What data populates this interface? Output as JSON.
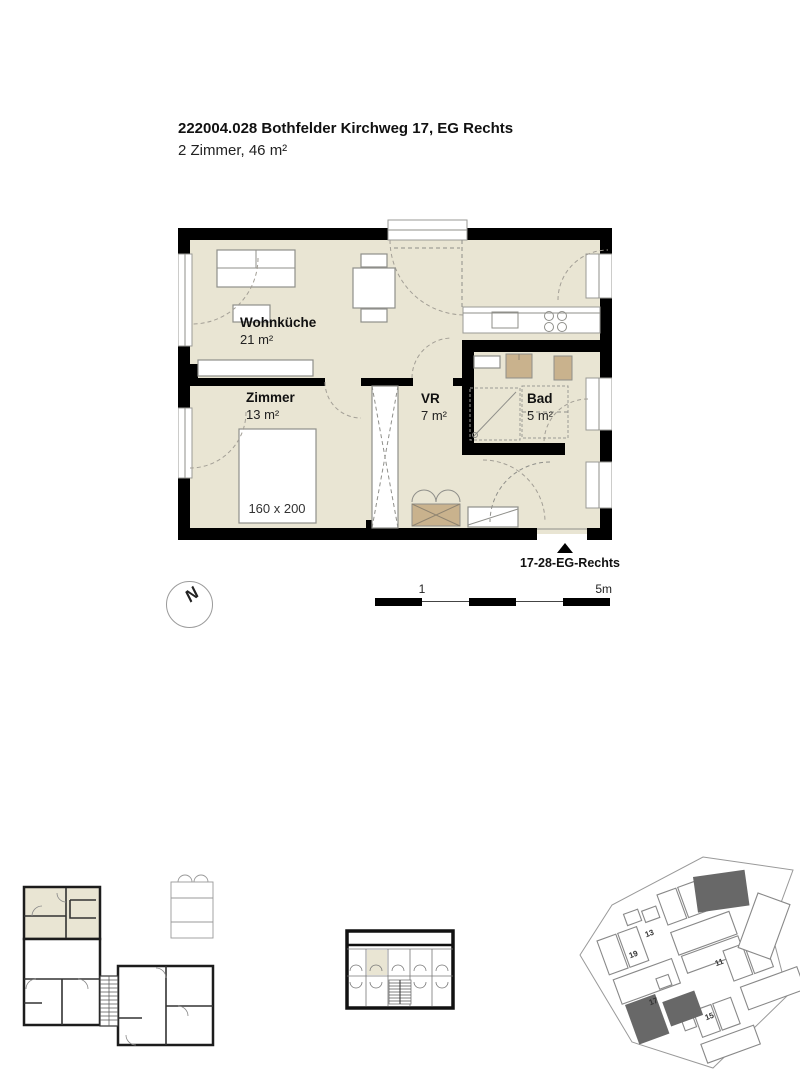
{
  "header": {
    "title": "222004.028 Bothfelder Kirchweg 17, EG Rechts",
    "subtitle": "2 Zimmer, 46 m²"
  },
  "floorplan": {
    "rooms": [
      {
        "name": "Wohnküche",
        "area": "21 m²"
      },
      {
        "name": "Zimmer",
        "area": "13 m²"
      },
      {
        "name": "VR",
        "area": "7 m²"
      },
      {
        "name": "Bad",
        "area": "5 m²"
      }
    ],
    "bed_label": "160 x 200",
    "colors": {
      "floor": "#e9e5d3",
      "wall": "#000000",
      "wood": "#c9b28d",
      "line": "#8f8f8a"
    }
  },
  "unit_marker": {
    "label": "17-28-EG-Rechts"
  },
  "scale_bar": {
    "tick_1": "1",
    "tick_5": "5m"
  },
  "north_indicator": {
    "label": "N"
  },
  "site_plan": {
    "buildings": [
      {
        "number": "19"
      },
      {
        "number": "13"
      },
      {
        "number": "11"
      },
      {
        "number": "17"
      },
      {
        "number": "15"
      }
    ]
  }
}
